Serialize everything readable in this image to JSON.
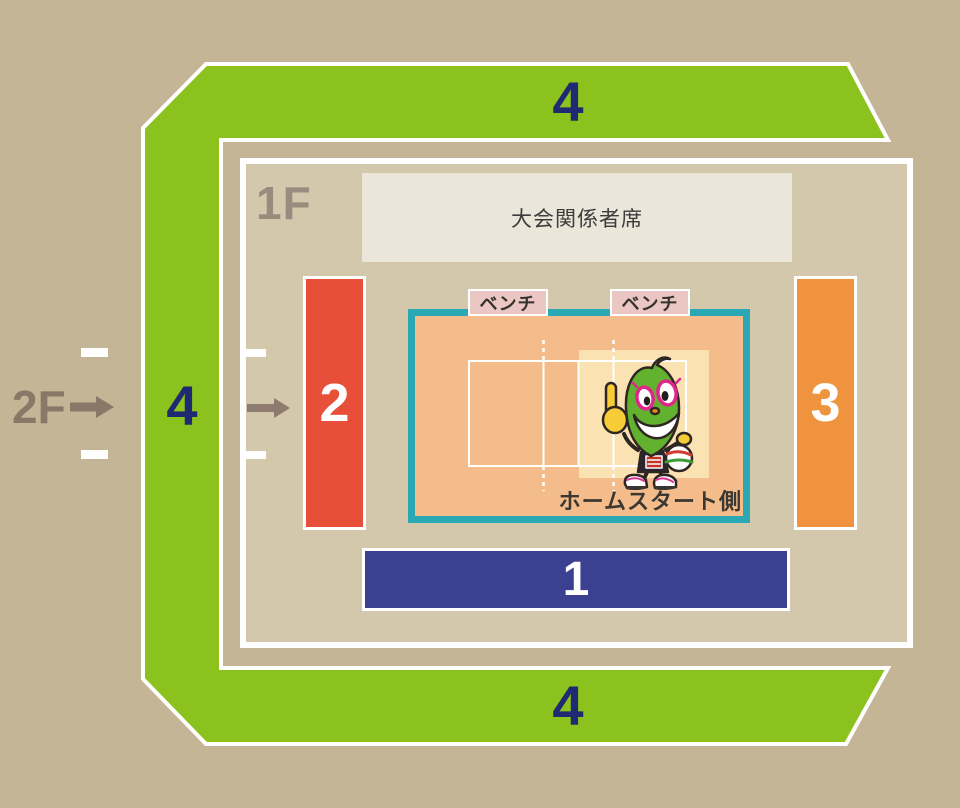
{
  "labels": {
    "floor1": "1F",
    "floor2": "2F",
    "officials_seats": "大会関係者席",
    "home_start_side": "ホームスタート側"
  },
  "benches": [
    {
      "label": "ベンチ"
    },
    {
      "label": "ベンチ"
    }
  ],
  "sections": {
    "one": "1",
    "two": "2",
    "three": "3",
    "four_top": "4",
    "four_left": "4",
    "four_bottom": "4"
  },
  "icons": {
    "first_floor_entrance_arrow": "right-arrow",
    "second_floor_entrance_arrow": "right-arrow",
    "mascot": "volleyball-leaf-mascot"
  },
  "colors": {
    "background_tan": "#c3b595",
    "stand_green": "#8cc21d",
    "navy_number": "#1f2a72",
    "frame_fill": "#d3c8ac",
    "officials_fill": "#eae6d9",
    "section1_navy": "#3c4090",
    "section2_red": "#e74f39",
    "section3_orange": "#f0933e",
    "court_border_teal": "#2aa9b4",
    "court_fill_peach": "#f4bc8a",
    "home_highlight_cream": "#fbe2b3",
    "bench_pink": "#ebc7c4",
    "floor_label_brown": "#9b8b7e",
    "arrow_brown": "#8d7b6d"
  }
}
